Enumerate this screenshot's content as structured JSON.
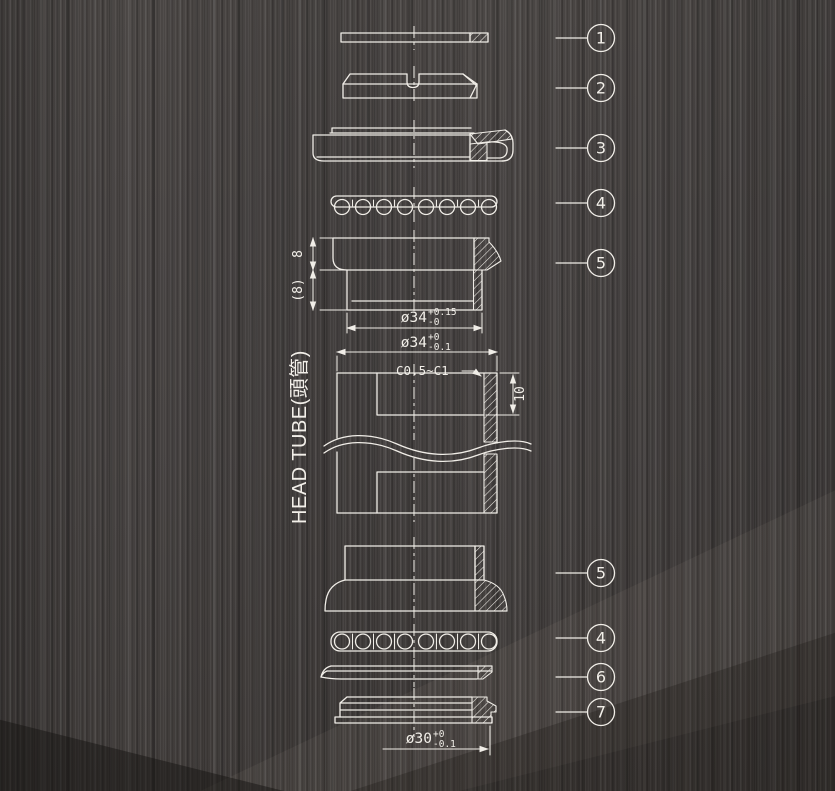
{
  "drawing": {
    "head_tube_label": "HEAD TUBE(頭管)",
    "chamfer_label": "C0.5~C1",
    "depth_label": "10",
    "cup_height_label": "8",
    "cup_stack_height_label": "(8)",
    "dim_cup_od": {
      "base": "ø34",
      "tol_upper": "+0.15",
      "tol_lower": "-0"
    },
    "dim_head_tube_bore": {
      "base": "ø34",
      "tol_upper": "+0",
      "tol_lower": "-0.1"
    },
    "dim_crown_race": {
      "base": "ø30",
      "tol_upper": "+0",
      "tol_lower": "-0.1"
    },
    "callouts_upper": [
      "1",
      "2",
      "3",
      "4",
      "5"
    ],
    "callouts_lower": [
      "5",
      "4",
      "6",
      "7"
    ],
    "colors": {
      "line": "#f0ede7",
      "background": "#454140"
    }
  }
}
